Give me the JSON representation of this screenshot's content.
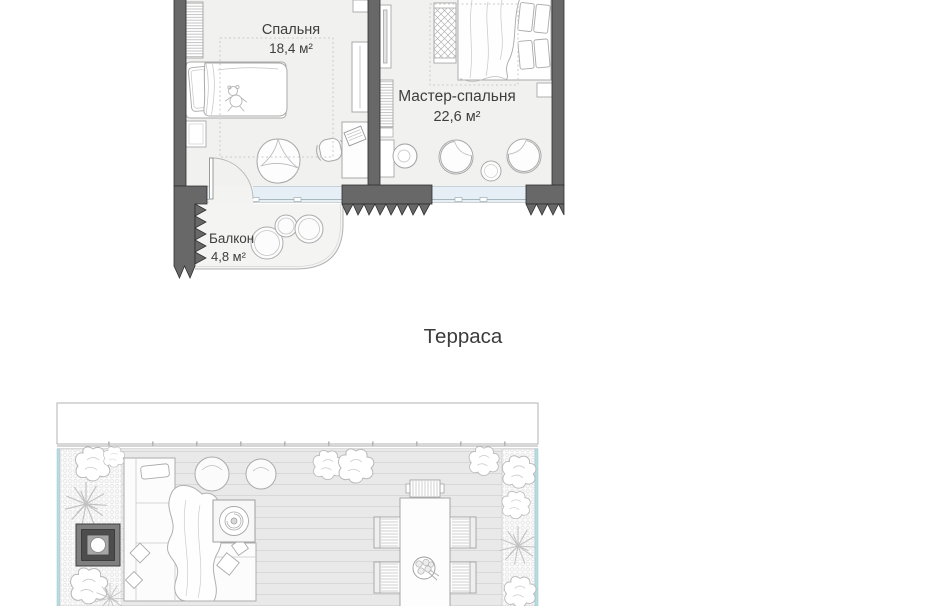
{
  "plan": {
    "rooms": [
      {
        "id": "bedroom",
        "name": "Спальня",
        "area": "18,4 м²"
      },
      {
        "id": "master",
        "name": "Мастер-спальня",
        "area": "22,6 м²"
      },
      {
        "id": "balcony",
        "name": "Балкон",
        "area": "4,8 м²"
      }
    ],
    "terrace_label": "Терраса"
  },
  "colors": {
    "wall": "#686868",
    "wall_outline": "#2f2f2f",
    "floor": "#f1f1ef",
    "glass": "#e6eff5",
    "deck": "#e9e9e9",
    "planting": "#fbfbfb",
    "railing_teal": "#b7dce2",
    "furniture_stroke": "#a9a9a9",
    "text": "#3e3e3e"
  }
}
